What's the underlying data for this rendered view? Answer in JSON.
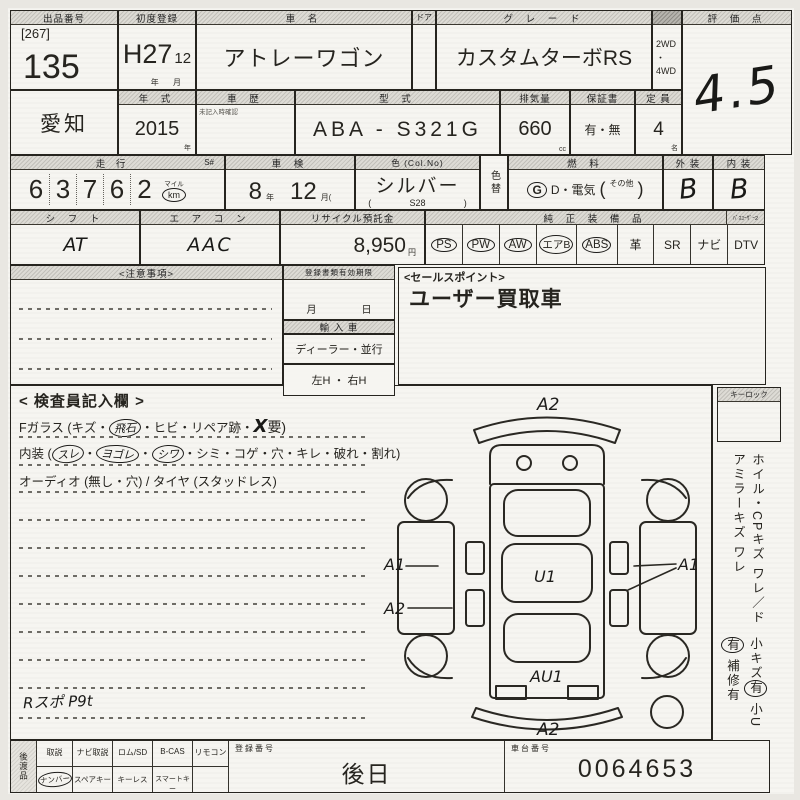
{
  "colors": {
    "paper": "#f6f5f1",
    "ink": "#26241f",
    "header_strip": "#d4d2cc"
  },
  "row1": {
    "lot_label": "出品番号",
    "lot_bracket": "[267]",
    "lot_number": "135",
    "reg_label": "初度登録",
    "reg_era": "H27",
    "reg_month": "12",
    "reg_unit": "年  月",
    "name_label": "車  名",
    "name_value": "アトレーワゴン",
    "door_label": "ドア",
    "grade_label": "グ レ ー ド",
    "grade_value": "カスタムターボRS",
    "drive_top": "2WD",
    "drive_mid": "・",
    "drive_bottom": "4WD",
    "score_label": "評 価 点",
    "score_value": "4.5"
  },
  "row2": {
    "region": "愛知",
    "year_label": "年 式",
    "year_value": "2015",
    "year_unit": "年",
    "history_label": "車 歴",
    "history_note": "未記入時確認",
    "model_label": "型 式",
    "model_value": "ABA - S321G",
    "disp_label": "排気量",
    "disp_value": "660",
    "disp_unit": "cc",
    "warranty_label": "保証書",
    "warranty_value": "有・無",
    "cap_label": "定 員",
    "cap_value": "4",
    "cap_unit": "名"
  },
  "row3": {
    "mileage_label": "走 行",
    "mileage_s": "S#",
    "mileage_digits": [
      "6",
      "3",
      "7",
      "6",
      "2"
    ],
    "mileage_unit_top": "マイル",
    "mileage_unit": "km",
    "insp_label": "車 検",
    "insp_year": "8",
    "insp_year_unit": "年",
    "insp_month": "12",
    "insp_month_unit": "月(",
    "color_label": "色 (Col.No)",
    "color_value": "シルバー",
    "color_paren_l": "(",
    "color_code": "S28",
    "color_paren_r": ")",
    "colorchg_label": "色替",
    "fuel_label": "燃 料",
    "fuel_g": "G",
    "fuel_text": "D・電気",
    "fuel_paren_l": "(",
    "fuel_other": "その他",
    "fuel_paren_r": ")",
    "ext_label": "外 装",
    "ext_value": "B",
    "int_label": "内 装",
    "int_value": "B"
  },
  "row4": {
    "shift_label": "シ フ ト",
    "shift_value": "AT",
    "aircon_label": "エ ア コ ン",
    "aircon_value": "AAC",
    "recycle_label": "リサイクル預託金",
    "recycle_value": "8,950",
    "recycle_unit": "円",
    "equip_label": "純 正 装 備 品",
    "equip_sub": "ﾊﾞｽﾕｰｻﾞｰ2",
    "equip_items": [
      {
        "text": "PS"
      },
      {
        "text": "PW"
      },
      {
        "text": "AW"
      },
      {
        "text": "エアB"
      },
      {
        "text": "ABS"
      },
      {
        "text": "革"
      },
      {
        "text": "SR"
      },
      {
        "text": "ナビ"
      },
      {
        "text": "DTV"
      }
    ]
  },
  "mid": {
    "notes_label": "<注意事項>",
    "docs_label": "登録書類有効期限",
    "docs_month": "月",
    "docs_day": "日",
    "import_label": "輸 入 車",
    "import_value": "ディーラー・並行",
    "handle_value": "左H ・ 右H",
    "sales_label": "<セールスポイント>",
    "sales_value": "ユーザー買取車"
  },
  "inspector": {
    "title": "< 検査員記入欄 >",
    "fglass_pre": "Fガラス (キズ・",
    "fglass_circled": "飛石",
    "fglass_mid": "・ヒビ・リペア跡・",
    "fglass_hand": "X",
    "fglass_suf": "要)",
    "interior_pre": "内装 (",
    "int_c1": "スレ",
    "sep": "・",
    "int_c2": "ヨゴレ",
    "int_c3": "シワ",
    "interior_suf": "・シミ・コゲ・穴・キレ・破れ・割れ)",
    "audio_line": "オーディオ (無し・穴) / タイヤ (スタッドレス)",
    "hand_note": "Rスポ P9t"
  },
  "diagram": {
    "top": "A2",
    "left1": "A1",
    "left2": "A2",
    "center": "U1",
    "right": "A1",
    "bottom_center": "AU1",
    "bottom": "A2"
  },
  "sidebar": {
    "keylock": "キーロック",
    "line1": "ホイル・CPキズ ワレ／ドアミラーキズ ワレ",
    "s1": "小キズ",
    "s1c": "有",
    "s2": "小U",
    "s2c": "有",
    "s3": "補修有"
  },
  "bottom": {
    "side_label": "後渡品",
    "cols": [
      {
        "top": "取説",
        "bottom": "ナンバー"
      },
      {
        "top": "ナビ取説",
        "bottom": "スペアキー"
      },
      {
        "top": "ロム/SD",
        "bottom": "キーレス"
      },
      {
        "top": "B-CAS",
        "bottom": "スマートキー"
      },
      {
        "top": "リモコン",
        "bottom": ""
      }
    ],
    "reg_label": "登録番号",
    "reg_value": "後日",
    "chassis_label": "車台番号",
    "chassis_value": "0064653"
  }
}
